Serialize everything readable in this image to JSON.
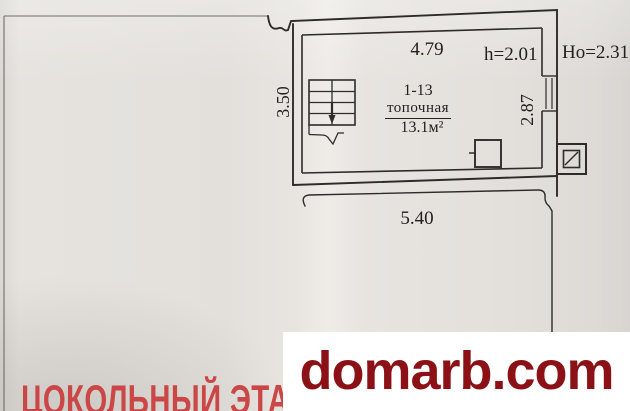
{
  "plan": {
    "room": {
      "number": "1-13",
      "name": "топочная",
      "area": "13.1м²"
    },
    "dims": {
      "top": "4.79",
      "ceiling_height": "h=2.01",
      "outer_height": "Ho=2.31",
      "left": "3.50",
      "right": "2.87",
      "bottom": "5.40"
    },
    "symbols": {
      "stairs": "stairs-symbol",
      "boiler": "boiler-symbol",
      "flue": "flue-symbol",
      "window": "window-symbol"
    }
  },
  "footer": {
    "floor_label": "ЦОКОЛЬНЫЙ ЭТАЖ"
  },
  "watermark": {
    "text": "domarb.com"
  },
  "colors": {
    "paper": "#e6e3df",
    "ink": "#2e2c29",
    "floor_label": "#cb4646",
    "watermark_text": "#8b1116",
    "watermark_bg": "#ffffff"
  }
}
